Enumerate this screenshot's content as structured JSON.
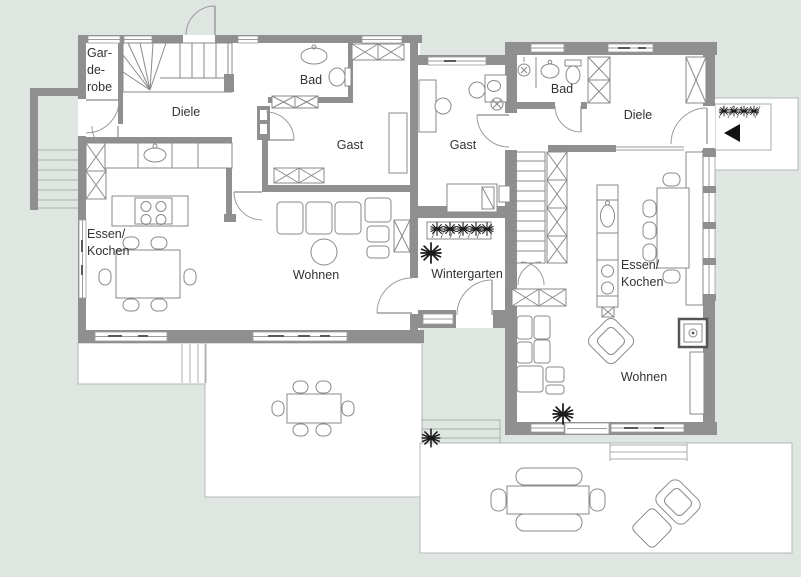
{
  "document": {
    "kind": "architectural floor plan, two dwelling units with terraces",
    "language": "de"
  },
  "colors": {
    "background": "#dfe6e2",
    "wall": "#8f8f8f",
    "floor": "#ffffff",
    "furniture_outline": "#8a8a8a",
    "terrace_border": "#b3bab6",
    "label_text": "#333333",
    "plant": "#1b1b1b",
    "entrance_arrow": "#111111"
  },
  "rooms": {
    "garderobe": "Gar-\nde-\nrobe",
    "diele_left": "Diele",
    "bad_left": "Bad",
    "gast_left": "Gast",
    "essen_kochen_left": "Essen/\nKochen",
    "wohnen_left": "Wohnen",
    "gast_middle": "Gast",
    "wintergarten": "Wintergarten",
    "bad_right": "Bad",
    "diele_right": "Diele",
    "essen_kochen_right": "Essen/\nKochen",
    "wohnen_right": "Wohnen"
  },
  "icons": {
    "entrance_arrow": "◀",
    "plant": "✳"
  }
}
